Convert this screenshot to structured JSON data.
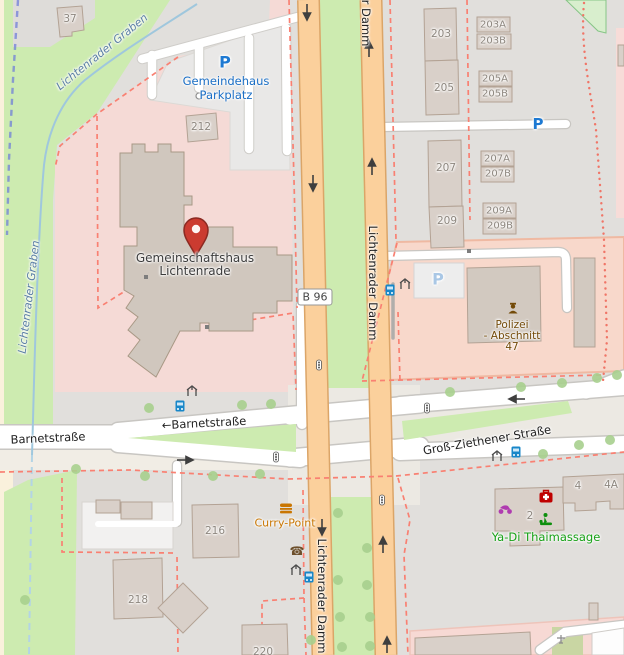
{
  "streets": {
    "lichtenrader_damm": "Lichtenrader Damm",
    "lichtenrader_damm_partial": "r Damm",
    "b96_ref": "B 96",
    "barnetstrasse": "Barnetstraße",
    "barnetstrasse_oneway": "←Barnetstraße",
    "gross_ziethener_strasse": "Groß-Ziethener Straße"
  },
  "water": {
    "stream_name": "Lichtenrader Graben"
  },
  "places": {
    "community_hall_line1": "Gemeinschaftshaus",
    "community_hall_line2": "Lichtenrade",
    "church_parking_line1": "Gemeindehaus",
    "church_parking_line2": "Parkplatz",
    "police_line1": "Polizei",
    "police_line2": "- Abschnitt",
    "police_line3": "47",
    "fast_food": "Curry-Point",
    "massage": "Ya-Di Thaimassage"
  },
  "house_numbers": {
    "n37": "37",
    "n212": "212",
    "n203": "203",
    "n203a": "203A",
    "n203b": "203B",
    "n205": "205",
    "n205a": "205A",
    "n205b": "205B",
    "n207": "207",
    "n207a": "207A",
    "n207b": "207B",
    "n209": "209",
    "n209a": "209A",
    "n209b": "209B",
    "n216": "216",
    "n218": "218",
    "n220": "220",
    "n2": "2",
    "n4": "4",
    "n4a": "4A"
  },
  "icons": {
    "parking_letter": "P",
    "phone_glyph": "☎"
  },
  "colors": {
    "marker_red": "#cb3b30",
    "primary_road": "#fbd09c",
    "grass": "#cdebb0",
    "residential_pink": "#f5dad6",
    "police_brown": "#734a08",
    "parking_blue": "#1d79d2",
    "water_blue": "#9fc7dd",
    "fastfood_orange": "#c97602",
    "massage_green": "#16a116"
  }
}
